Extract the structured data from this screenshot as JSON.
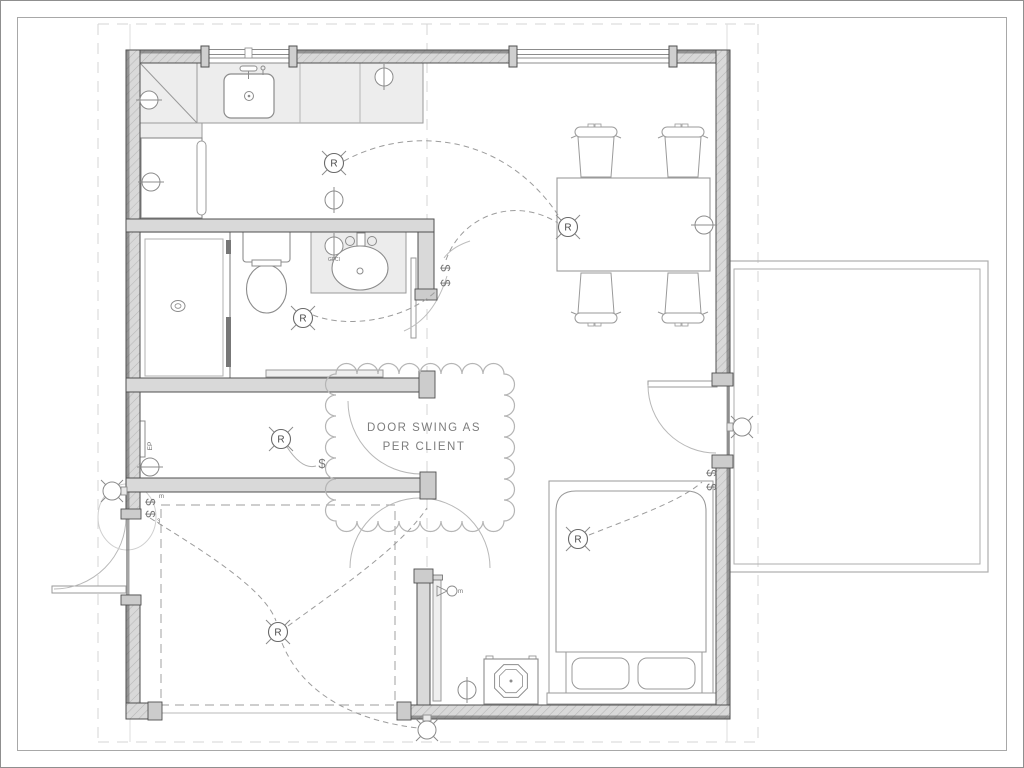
{
  "page": {
    "background": "#ffffff",
    "sheet_border_color": "#9a9a9a",
    "guide_line_color": "#d4d4d4"
  },
  "drawing": {
    "type": "floor-plan",
    "annotation_cloud": {
      "line1": "DOOR SWING AS",
      "line2": "PER CLIENT"
    },
    "labels": {
      "electrical_panel": "EP",
      "gfci_outlet": "GFCI",
      "receptacle_letter": "R",
      "switch_glyph": "$",
      "three_way_marker": "3",
      "motion_marker": "m"
    },
    "colors": {
      "wall_fill": "#d9d9d9",
      "wall_edge": "#4f4f4f",
      "fixture_line": "#8c8c8c",
      "counter_fill": "#ededed",
      "wiring": "#9c9c9c",
      "cloud": "#b5b5b5",
      "annotation_text": "#7d7d7d"
    },
    "symbols": {
      "receptacles": [
        {
          "area": "kitchen",
          "x": 334,
          "y": 163
        },
        {
          "area": "dining",
          "x": 568,
          "y": 227
        },
        {
          "area": "bathroom",
          "x": 303,
          "y": 318
        },
        {
          "area": "hallway",
          "x": 281,
          "y": 439
        },
        {
          "area": "garage",
          "x": 278,
          "y": 632
        },
        {
          "area": "bedroom",
          "x": 578,
          "y": 539
        }
      ],
      "switches": [
        {
          "area": "entry",
          "x": 146,
          "y": 502,
          "rot": 90
        },
        {
          "area": "entry",
          "x": 146,
          "y": 514,
          "rot": 90
        },
        {
          "area": "hallway",
          "x": 322,
          "y": 468,
          "rot": 0
        },
        {
          "area": "bathroom-door",
          "x": 441,
          "y": 268,
          "rot": 90
        },
        {
          "area": "bathroom-door",
          "x": 441,
          "y": 283,
          "rot": 90
        },
        {
          "area": "deck-door",
          "x": 707,
          "y": 473,
          "rot": 90
        },
        {
          "area": "deck-door",
          "x": 707,
          "y": 487,
          "rot": 90
        }
      ],
      "outlets": [
        {
          "area": "kitchen-wall-upper",
          "x": 149,
          "y": 100,
          "dir": "h"
        },
        {
          "area": "kitchen-wall-lower",
          "x": 151,
          "y": 182,
          "dir": "h"
        },
        {
          "area": "kitchen-counter",
          "x": 384,
          "y": 77,
          "dir": "v"
        },
        {
          "area": "kitchen-divider",
          "x": 334,
          "y": 200,
          "dir": "v"
        },
        {
          "area": "bathroom-gfci",
          "x": 334,
          "y": 246,
          "dir": "v"
        },
        {
          "area": "hallway",
          "x": 150,
          "y": 467,
          "dir": "h"
        },
        {
          "area": "dining-east",
          "x": 704,
          "y": 225,
          "dir": "h"
        },
        {
          "area": "bedroom-south",
          "x": 467,
          "y": 690,
          "dir": "v"
        }
      ],
      "wall_lights": [
        {
          "area": "entry-exterior",
          "x": 112,
          "y": 491,
          "mount": "right"
        },
        {
          "area": "deck-exterior",
          "x": 742,
          "y": 427,
          "mount": "left"
        },
        {
          "area": "rear-exterior",
          "x": 427,
          "y": 730,
          "mount": "top"
        }
      ],
      "markers": [
        {
          "kind": "three_way_marker",
          "x": 157,
          "y": 523
        },
        {
          "kind": "motion_marker",
          "x": 159,
          "y": 498
        },
        {
          "kind": "motion_marker",
          "x": 458,
          "y": 593
        }
      ]
    }
  }
}
